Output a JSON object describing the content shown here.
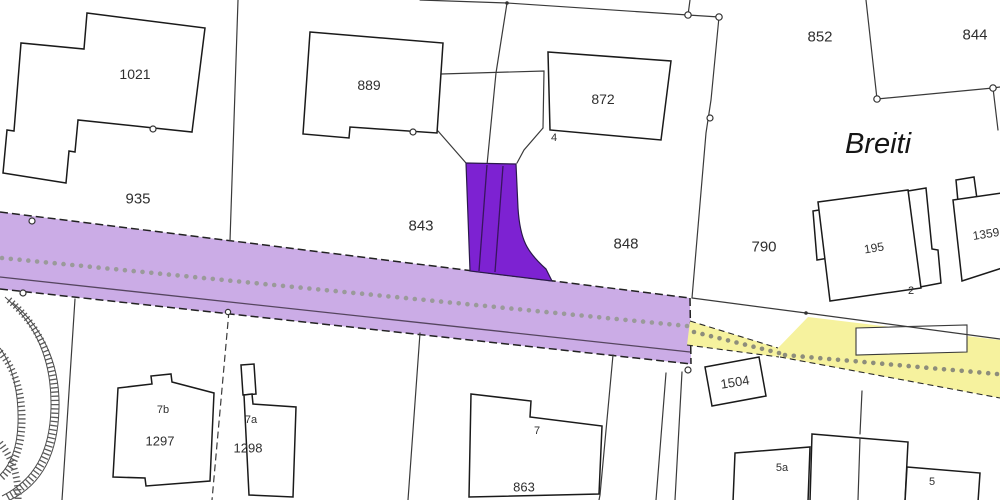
{
  "map": {
    "place_name": "Breiti",
    "colors": {
      "road_highlight": "#cbace6",
      "road_highlight_edge": "#222222",
      "selected_parcel": "#7d22d2",
      "selected_parcel_edge": "#2a1a4a",
      "path_highlight": "#f6f29e",
      "dots_on_purple": "#9a9a9a",
      "dots_on_yellow": "#8d8d7b",
      "road_inner_line": "#55455f",
      "background": "#ffffff"
    },
    "labels": [
      {
        "name": "parcel-label-1021",
        "text": "1021",
        "x": 135,
        "y": 74,
        "size": 14,
        "rot": 0,
        "cls": "parcel"
      },
      {
        "name": "parcel-label-935",
        "text": "935",
        "x": 138,
        "y": 199,
        "size": 15,
        "rot": 0,
        "cls": "parcel"
      },
      {
        "name": "parcel-label-889",
        "text": "889",
        "x": 369,
        "y": 85,
        "size": 14,
        "rot": 0,
        "cls": "parcel"
      },
      {
        "name": "parcel-label-843",
        "text": "843",
        "x": 421,
        "y": 226,
        "size": 15,
        "rot": 0,
        "cls": "parcel"
      },
      {
        "name": "parcel-label-872",
        "text": "872",
        "x": 603,
        "y": 99,
        "size": 14,
        "rot": 0,
        "cls": "parcel"
      },
      {
        "name": "parcel-label-848",
        "text": "848",
        "x": 626,
        "y": 244,
        "size": 15,
        "rot": 0,
        "cls": "parcel"
      },
      {
        "name": "parcel-label-852",
        "text": "852",
        "x": 820,
        "y": 37,
        "size": 15,
        "rot": 0,
        "cls": "parcel"
      },
      {
        "name": "parcel-label-844",
        "text": "844",
        "x": 975,
        "y": 35,
        "size": 15,
        "rot": 0,
        "cls": "parcel"
      },
      {
        "name": "parcel-label-790",
        "text": "790",
        "x": 764,
        "y": 247,
        "size": 15,
        "rot": 0,
        "cls": "parcel"
      },
      {
        "name": "parcel-label-195",
        "text": "195",
        "x": 874,
        "y": 248,
        "size": 12,
        "rot": -9,
        "cls": "parcel"
      },
      {
        "name": "parcel-label-1359",
        "text": "1359",
        "x": 986,
        "y": 234,
        "size": 12,
        "rot": -9,
        "cls": "parcel"
      },
      {
        "name": "parcel-label-1504",
        "text": "1504",
        "x": 735,
        "y": 382,
        "size": 13,
        "rot": -9,
        "cls": "parcel"
      },
      {
        "name": "parcel-label-1297",
        "text": "1297",
        "x": 160,
        "y": 441,
        "size": 13,
        "rot": 0,
        "cls": "parcel"
      },
      {
        "name": "parcel-label-1298",
        "text": "1298",
        "x": 248,
        "y": 448,
        "size": 13,
        "rot": 0,
        "cls": "parcel"
      },
      {
        "name": "parcel-label-863",
        "text": "863",
        "x": 524,
        "y": 487,
        "size": 13,
        "rot": 0,
        "cls": "parcel"
      },
      {
        "name": "house-number-4",
        "text": "4",
        "x": 554,
        "y": 138,
        "size": 11,
        "rot": 0,
        "cls": "house"
      },
      {
        "name": "house-number-2",
        "text": "2",
        "x": 911,
        "y": 291,
        "size": 11,
        "rot": 0,
        "cls": "house"
      },
      {
        "name": "house-number-7b",
        "text": "7b",
        "x": 163,
        "y": 410,
        "size": 11,
        "rot": 0,
        "cls": "house"
      },
      {
        "name": "house-number-7a",
        "text": "7a",
        "x": 251,
        "y": 420,
        "size": 11,
        "rot": 0,
        "cls": "house"
      },
      {
        "name": "house-number-7",
        "text": "7",
        "x": 537,
        "y": 431,
        "size": 11,
        "rot": 0,
        "cls": "house"
      },
      {
        "name": "house-number-5a",
        "text": "5a",
        "x": 782,
        "y": 468,
        "size": 11,
        "rot": 0,
        "cls": "house"
      },
      {
        "name": "house-number-5",
        "text": "5",
        "x": 932,
        "y": 482,
        "size": 11,
        "rot": 0,
        "cls": "house"
      },
      {
        "name": "place-label-breiti",
        "text": "Breiti",
        "x": 878,
        "y": 144,
        "size": 29,
        "rot": 0,
        "cls": "place"
      }
    ],
    "path_dots": {
      "segments": [
        {
          "name": "dotted-path-on-road",
          "x0": 2,
          "y0": 258,
          "x1": 687,
          "y1": 326,
          "spacing": 8.8,
          "r": 2.3,
          "color_key": "dots_on_purple"
        },
        {
          "name": "dotted-path-yellow-narrow",
          "x0": 694,
          "y0": 332,
          "x1": 779,
          "y1": 353,
          "spacing": 8.6,
          "r": 2.3,
          "color_key": "dots_on_yellow"
        },
        {
          "name": "dotted-path-yellow-wide",
          "x0": 785,
          "y0": 355,
          "x1": 997,
          "y1": 374,
          "spacing": 8.6,
          "r": 2.3,
          "color_key": "dots_on_yellow"
        }
      ]
    }
  }
}
